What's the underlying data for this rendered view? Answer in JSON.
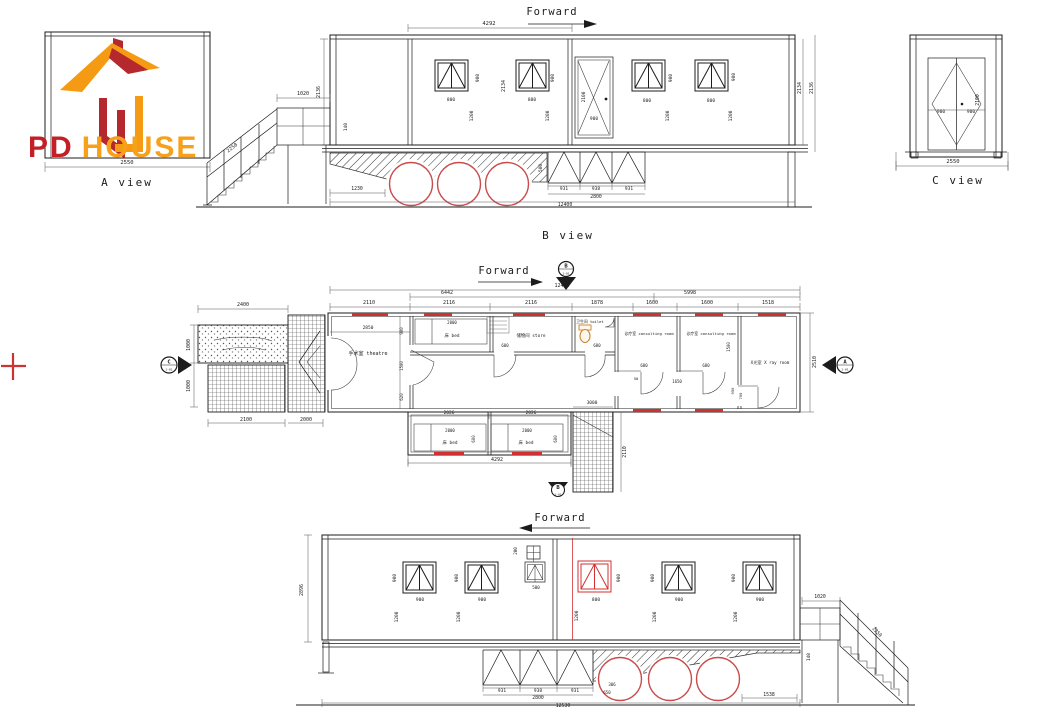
{
  "labels": {
    "forward": "Forward",
    "a_view": "A view",
    "b_view": "B view",
    "c_view": "C view"
  },
  "brand": {
    "pd": "PD",
    "house": "HOUSE"
  },
  "markers": {
    "b_top": {
      "letter": "B",
      "sub": "1-01"
    },
    "c_left": {
      "letter": "C",
      "sub": "1-01"
    },
    "a_right": {
      "letter": "A",
      "sub": "1-01"
    },
    "b_bottom": {
      "letter": "B",
      "sub": "1-01"
    }
  },
  "colors": {
    "line": "#1c1c1c",
    "accent_red": "#d03030",
    "wheel_red": "#c94b4b",
    "brand_pd": "#C41E26",
    "brand_house": "#F7A11A",
    "logo_orange": "#F59B13",
    "logo_red": "#B4282E",
    "toilet_tan": "#c8862c"
  },
  "rooms": [
    {
      "label": "手术室 theatre",
      "x": 368,
      "y": 355,
      "s": 5
    },
    {
      "label": "床 bed",
      "x": 452,
      "y": 337,
      "s": 4.4
    },
    {
      "label": "储物间 store",
      "x": 531,
      "y": 337,
      "s": 4.4
    },
    {
      "label": "卫生间 toilet",
      "x": 590,
      "y": 323,
      "s": 3.8
    },
    {
      "label": "诊疗室 consulting room",
      "x": 649,
      "y": 335,
      "s": 3.9
    },
    {
      "label": "诊疗室 consulting room",
      "x": 711,
      "y": 335,
      "s": 3.9
    },
    {
      "label": "X光室 X ray room",
      "x": 770,
      "y": 364,
      "s": 4.2
    },
    {
      "label": "床 bed",
      "x": 450,
      "y": 444,
      "s": 4.4
    },
    {
      "label": "床 bed",
      "x": 526,
      "y": 444,
      "s": 4.4
    }
  ],
  "dimensions": [
    {
      "t": "4292",
      "x": 489,
      "y": 25,
      "s": 5.5
    },
    {
      "t": "2136",
      "x": 320,
      "y": 92,
      "r": -90,
      "s": 5
    },
    {
      "t": "140",
      "x": 347,
      "y": 127,
      "r": -90,
      "s": 4.5
    },
    {
      "t": "2134",
      "x": 505,
      "y": 86,
      "r": -90,
      "s": 5
    },
    {
      "t": "900",
      "x": 479,
      "y": 78,
      "r": -90,
      "s": 4.5
    },
    {
      "t": "800",
      "x": 451,
      "y": 101,
      "s": 4.5
    },
    {
      "t": "1200",
      "x": 473,
      "y": 116,
      "r": -90,
      "s": 4.5
    },
    {
      "t": "900",
      "x": 554,
      "y": 78,
      "r": -90,
      "s": 4.5
    },
    {
      "t": "800",
      "x": 532,
      "y": 101,
      "s": 4.5
    },
    {
      "t": "1200",
      "x": 549,
      "y": 116,
      "r": -90,
      "s": 4.5
    },
    {
      "t": "2100",
      "x": 585,
      "y": 97,
      "r": -90,
      "s": 4.5
    },
    {
      "t": "900",
      "x": 594,
      "y": 120,
      "s": 4.5
    },
    {
      "t": "900",
      "x": 672,
      "y": 78,
      "r": -90,
      "s": 4.5
    },
    {
      "t": "800",
      "x": 647,
      "y": 102,
      "s": 4.5
    },
    {
      "t": "1200",
      "x": 669,
      "y": 116,
      "r": -90,
      "s": 4.5
    },
    {
      "t": "900",
      "x": 735,
      "y": 77,
      "r": -90,
      "s": 4.5
    },
    {
      "t": "800",
      "x": 711,
      "y": 102,
      "s": 4.5
    },
    {
      "t": "1200",
      "x": 732,
      "y": 116,
      "r": -90,
      "s": 4.5
    },
    {
      "t": "2134",
      "x": 801,
      "y": 88,
      "r": -90,
      "s": 5
    },
    {
      "t": "2136",
      "x": 813,
      "y": 88,
      "r": -90,
      "s": 5
    },
    {
      "t": "1020",
      "x": 303,
      "y": 95,
      "s": 5
    },
    {
      "t": "2250",
      "x": 233,
      "y": 149,
      "r": -38,
      "s": 5
    },
    {
      "t": "1230",
      "x": 357,
      "y": 190,
      "s": 4.8
    },
    {
      "t": "931",
      "x": 564,
      "y": 190,
      "s": 4.5
    },
    {
      "t": "938",
      "x": 596,
      "y": 190,
      "s": 4.5
    },
    {
      "t": "931",
      "x": 629,
      "y": 190,
      "s": 4.5
    },
    {
      "t": "2800",
      "x": 596,
      "y": 198,
      "s": 4.8
    },
    {
      "t": "12400",
      "x": 565,
      "y": 206,
      "s": 4.8
    },
    {
      "t": "500",
      "x": 542,
      "y": 168,
      "r": -90,
      "s": 4.5
    },
    {
      "t": "2100",
      "x": 979,
      "y": 100,
      "r": -90,
      "s": 4.8
    },
    {
      "t": "900",
      "x": 941,
      "y": 113,
      "s": 4.5
    },
    {
      "t": "900",
      "x": 971,
      "y": 113,
      "s": 4.5
    },
    {
      "t": "2550",
      "x": 953,
      "y": 163,
      "s": 5.5
    },
    {
      "t": "2550",
      "x": 127,
      "y": 164,
      "s": 5.5
    },
    {
      "t": "12400",
      "x": 562,
      "y": 287,
      "s": 5
    },
    {
      "t": "6442",
      "x": 447,
      "y": 294,
      "s": 5
    },
    {
      "t": "5998",
      "x": 690,
      "y": 294,
      "s": 5
    },
    {
      "t": "2110",
      "x": 369,
      "y": 304,
      "s": 5
    },
    {
      "t": "2116",
      "x": 449,
      "y": 304,
      "s": 5
    },
    {
      "t": "2116",
      "x": 531,
      "y": 304,
      "s": 5
    },
    {
      "t": "1878",
      "x": 597,
      "y": 304,
      "s": 5
    },
    {
      "t": "1600",
      "x": 652,
      "y": 304,
      "s": 5
    },
    {
      "t": "1600",
      "x": 707,
      "y": 304,
      "s": 5
    },
    {
      "t": "1518",
      "x": 768,
      "y": 304,
      "s": 5
    },
    {
      "t": "2400",
      "x": 243,
      "y": 306,
      "s": 5
    },
    {
      "t": "1000",
      "x": 190,
      "y": 345,
      "r": -90,
      "s": 5
    },
    {
      "t": "1000",
      "x": 190,
      "y": 386,
      "r": -90,
      "s": 5
    },
    {
      "t": "2100",
      "x": 246,
      "y": 421,
      "s": 5
    },
    {
      "t": "2000",
      "x": 306,
      "y": 421,
      "s": 5
    },
    {
      "t": "2850",
      "x": 368,
      "y": 329,
      "s": 4.5
    },
    {
      "t": "900",
      "x": 403,
      "y": 331,
      "r": -90,
      "s": 4
    },
    {
      "t": "1500",
      "x": 403,
      "y": 366,
      "r": -90,
      "s": 4
    },
    {
      "t": "620",
      "x": 403,
      "y": 397,
      "r": -90,
      "s": 4
    },
    {
      "t": "2000",
      "x": 452,
      "y": 324,
      "s": 4
    },
    {
      "t": "600",
      "x": 505,
      "y": 347,
      "s": 4
    },
    {
      "t": "680",
      "x": 597,
      "y": 347,
      "s": 4
    },
    {
      "t": "680",
      "x": 644,
      "y": 367,
      "s": 4
    },
    {
      "t": "50",
      "x": 636,
      "y": 380,
      "s": 3.8
    },
    {
      "t": "680",
      "x": 706,
      "y": 367,
      "s": 4
    },
    {
      "t": "1650",
      "x": 677,
      "y": 383,
      "s": 4
    },
    {
      "t": "1500",
      "x": 730,
      "y": 347,
      "r": -90,
      "s": 4
    },
    {
      "t": "950",
      "x": 734,
      "y": 391,
      "r": -90,
      "s": 3.8
    },
    {
      "t": "700",
      "x": 742,
      "y": 396,
      "r": -90,
      "s": 3.8
    },
    {
      "t": "2510",
      "x": 816,
      "y": 362,
      "r": -90,
      "s": 5
    },
    {
      "t": "3000",
      "x": 592,
      "y": 404,
      "s": 4.5
    },
    {
      "t": "2110",
      "x": 626,
      "y": 452,
      "r": -90,
      "s": 4.8
    },
    {
      "t": "2026",
      "x": 449,
      "y": 414,
      "s": 4.5
    },
    {
      "t": "2026",
      "x": 531,
      "y": 414,
      "s": 4.5
    },
    {
      "t": "2000",
      "x": 450,
      "y": 432,
      "s": 4
    },
    {
      "t": "2000",
      "x": 527,
      "y": 432,
      "s": 4
    },
    {
      "t": "600",
      "x": 475,
      "y": 439,
      "r": -90,
      "s": 4
    },
    {
      "t": "600",
      "x": 557,
      "y": 439,
      "r": -90,
      "s": 4
    },
    {
      "t": "4292",
      "x": 497,
      "y": 461,
      "s": 5
    },
    {
      "t": "2896",
      "x": 303,
      "y": 590,
      "r": -90,
      "s": 5
    },
    {
      "t": "900",
      "x": 396,
      "y": 578,
      "r": -90,
      "s": 4.5
    },
    {
      "t": "900",
      "x": 420,
      "y": 601,
      "s": 4.5
    },
    {
      "t": "1200",
      "x": 398,
      "y": 617,
      "r": -90,
      "s": 4.5
    },
    {
      "t": "900",
      "x": 458,
      "y": 578,
      "r": -90,
      "s": 4.5
    },
    {
      "t": "900",
      "x": 482,
      "y": 601,
      "s": 4.5
    },
    {
      "t": "1200",
      "x": 460,
      "y": 617,
      "r": -90,
      "s": 4.5
    },
    {
      "t": "200",
      "x": 517,
      "y": 551,
      "r": -90,
      "s": 4.2
    },
    {
      "t": "500",
      "x": 536,
      "y": 589,
      "s": 4.2
    },
    {
      "t": "900",
      "x": 620,
      "y": 578,
      "r": -90,
      "s": 4.5,
      "c": "#d03030"
    },
    {
      "t": "800",
      "x": 596,
      "y": 601,
      "s": 4.5,
      "c": "#d03030"
    },
    {
      "t": "1200",
      "x": 578,
      "y": 616,
      "r": -90,
      "s": 4.5,
      "c": "#d03030"
    },
    {
      "t": "900",
      "x": 654,
      "y": 578,
      "r": -90,
      "s": 4.5
    },
    {
      "t": "900",
      "x": 679,
      "y": 601,
      "s": 4.5
    },
    {
      "t": "1200",
      "x": 656,
      "y": 617,
      "r": -90,
      "s": 4.5
    },
    {
      "t": "900",
      "x": 735,
      "y": 578,
      "r": -90,
      "s": 4.5
    },
    {
      "t": "900",
      "x": 760,
      "y": 601,
      "s": 4.5
    },
    {
      "t": "1200",
      "x": 737,
      "y": 617,
      "r": -90,
      "s": 4.5
    },
    {
      "t": "931",
      "x": 502,
      "y": 692,
      "s": 4.5
    },
    {
      "t": "938",
      "x": 538,
      "y": 692,
      "s": 4.5
    },
    {
      "t": "931",
      "x": 575,
      "y": 692,
      "s": 4.5
    },
    {
      "t": "2800",
      "x": 538,
      "y": 699,
      "s": 4.8
    },
    {
      "t": "12530",
      "x": 563,
      "y": 707,
      "s": 4.8
    },
    {
      "t": "306",
      "x": 612,
      "y": 686,
      "s": 4
    },
    {
      "t": "650",
      "x": 607,
      "y": 694,
      "s": 4
    },
    {
      "t": "1538",
      "x": 769,
      "y": 696,
      "s": 4.8
    },
    {
      "t": "140",
      "x": 810,
      "y": 657,
      "r": -90,
      "s": 4.5
    },
    {
      "t": "1020",
      "x": 820,
      "y": 598,
      "s": 4.8
    },
    {
      "t": "2250",
      "x": 876,
      "y": 633,
      "r": 47,
      "s": 4.8
    }
  ]
}
